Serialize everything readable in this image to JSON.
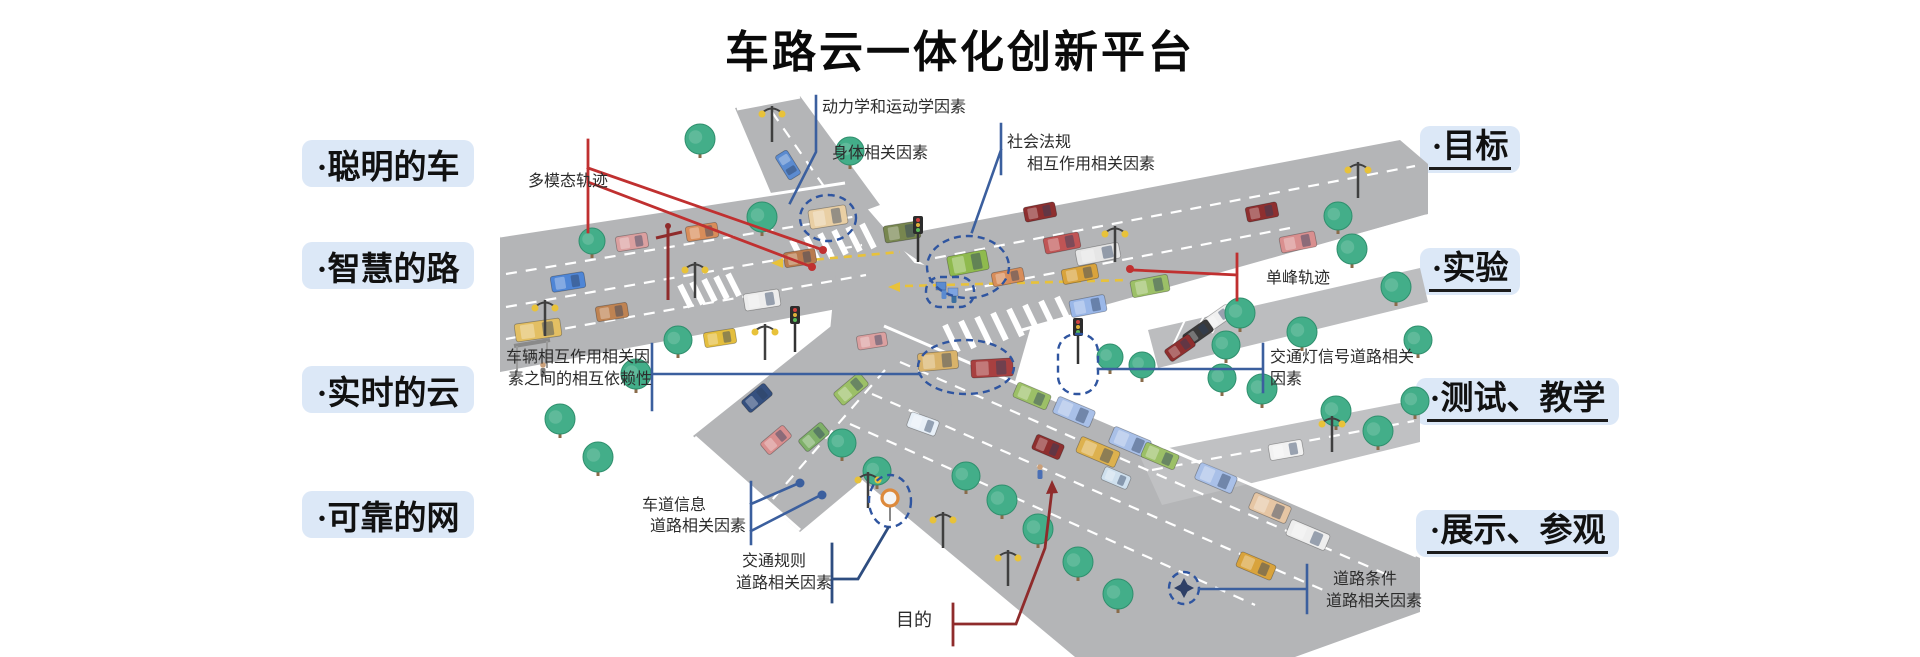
{
  "title": "车路云一体化创新平台",
  "left_labels": [
    "·聪明的车",
    "·智慧的路",
    "·实时的云",
    "·可靠的网"
  ],
  "right_labels": [
    "·目标",
    "·实验",
    "·测试、教学",
    "·展示、参观"
  ],
  "annotations": {
    "dynamics": "动力学和运动学因素",
    "body_factors": "身体相关因素",
    "social_1": "社会法规",
    "social_2": "相互作用相关因素",
    "multimodal_traj": "多模态轨迹",
    "interaction_1": "车辆相互作用相关因",
    "interaction_2": "素之间的相互依赖性",
    "unimodal_traj": "单峰轨迹",
    "signal_1": "交通灯信号道路相关",
    "signal_2": "因素",
    "lane_1": "车道信息",
    "lane_2": "道路相关因素",
    "rules_1": "交通规则",
    "rules_2": "道路相关因素",
    "purpose": "目的",
    "roadcond_1": "道路条件",
    "roadcond_2": "道路相关因素"
  },
  "colors": {
    "label_bg": "#dce8f7",
    "callout_blue": "#3b5f9e",
    "callout_dark_blue": "#2e4d80",
    "callout_red": "#c03030",
    "callout_dark_red": "#8f2b2b",
    "highlight_dashed": "#2f55a0",
    "road": "#b4b5b7",
    "text": "#2b2b2b"
  }
}
